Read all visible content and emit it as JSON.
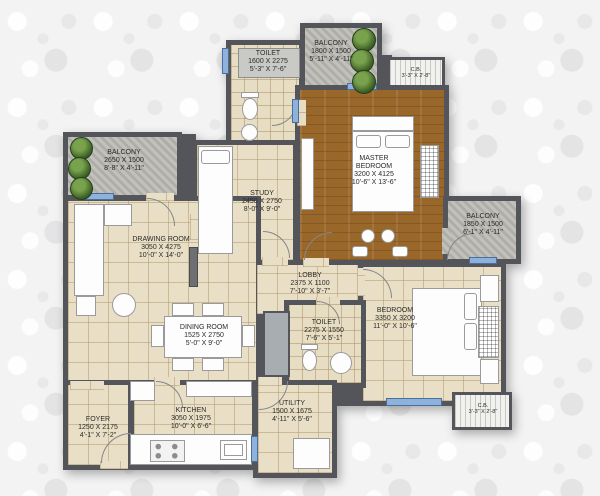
{
  "plan_title": "2BHK + Study Floor Plan",
  "rooms": [
    {
      "id": "toilet-top",
      "name": "TOILET",
      "mm": "1600 X 2275",
      "ft": "5'-3\" X 7'-6\""
    },
    {
      "id": "balcony-top",
      "name": "BALCONY",
      "mm": "1800 X 1500",
      "ft": "5'-11\" X 4'-11\""
    },
    {
      "id": "cb-top",
      "name": "C.B.",
      "ft": "3'-3\" X 2'-8\""
    },
    {
      "id": "master-bedroom",
      "name": "MASTER BEDROOM",
      "mm": "3200 X 4125",
      "ft": "10'-6\" X 13'-6\""
    },
    {
      "id": "balcony-left",
      "name": "BALCONY",
      "mm": "2650 X 1500",
      "ft": "8'-8\" X 4'-11\""
    },
    {
      "id": "study",
      "name": "STUDY",
      "mm": "2450 X 2750",
      "ft": "8'-0\" X 9'-0\""
    },
    {
      "id": "drawing-room",
      "name": "DRAWING ROOM",
      "mm": "3050 X 4275",
      "ft": "10'-0\" X 14'-0\""
    },
    {
      "id": "lobby",
      "name": "LOBBY",
      "mm": "2375 X 1100",
      "ft": "7'-10\" X 3'-7\""
    },
    {
      "id": "balcony-right",
      "name": "BALCONY",
      "mm": "1850 X 1500",
      "ft": "6'-1\" X 4'-11\""
    },
    {
      "id": "dining-room",
      "name": "DINING ROOM",
      "mm": "1525 X 2750",
      "ft": "5'-0\" X 9'-0\""
    },
    {
      "id": "toilet-mid",
      "name": "TOILET",
      "mm": "2275 X 1550",
      "ft": "7'-6\" X 5'-1\""
    },
    {
      "id": "bedroom",
      "name": "BEDROOM",
      "mm": "3350 X 3200",
      "ft": "11'-0\" X 10'-6\""
    },
    {
      "id": "cb-bottom",
      "name": "C.B.",
      "ft": "3'-3\" X 2'-8\""
    },
    {
      "id": "foyer",
      "name": "FOYER",
      "mm": "1250 X 2175",
      "ft": "4'-1\" X 7'-2\""
    },
    {
      "id": "kitchen",
      "name": "KITCHEN",
      "mm": "3050 X 1975",
      "ft": "10'-0\" X 6'-6\""
    },
    {
      "id": "utility",
      "name": "UTILITY",
      "mm": "1500 X 1675",
      "ft": "4'-11\" X 5'-6\""
    }
  ],
  "colors": {
    "wall": "#54555a",
    "tile_floor": "#e9dfc6",
    "wood_floor": "#9a672b",
    "balcony_floor": "#b9b8b2",
    "window": "#8fb2dc",
    "plant": "#3c5e26",
    "label_text": "#2a2a2a",
    "background": "#f3f3f3"
  }
}
